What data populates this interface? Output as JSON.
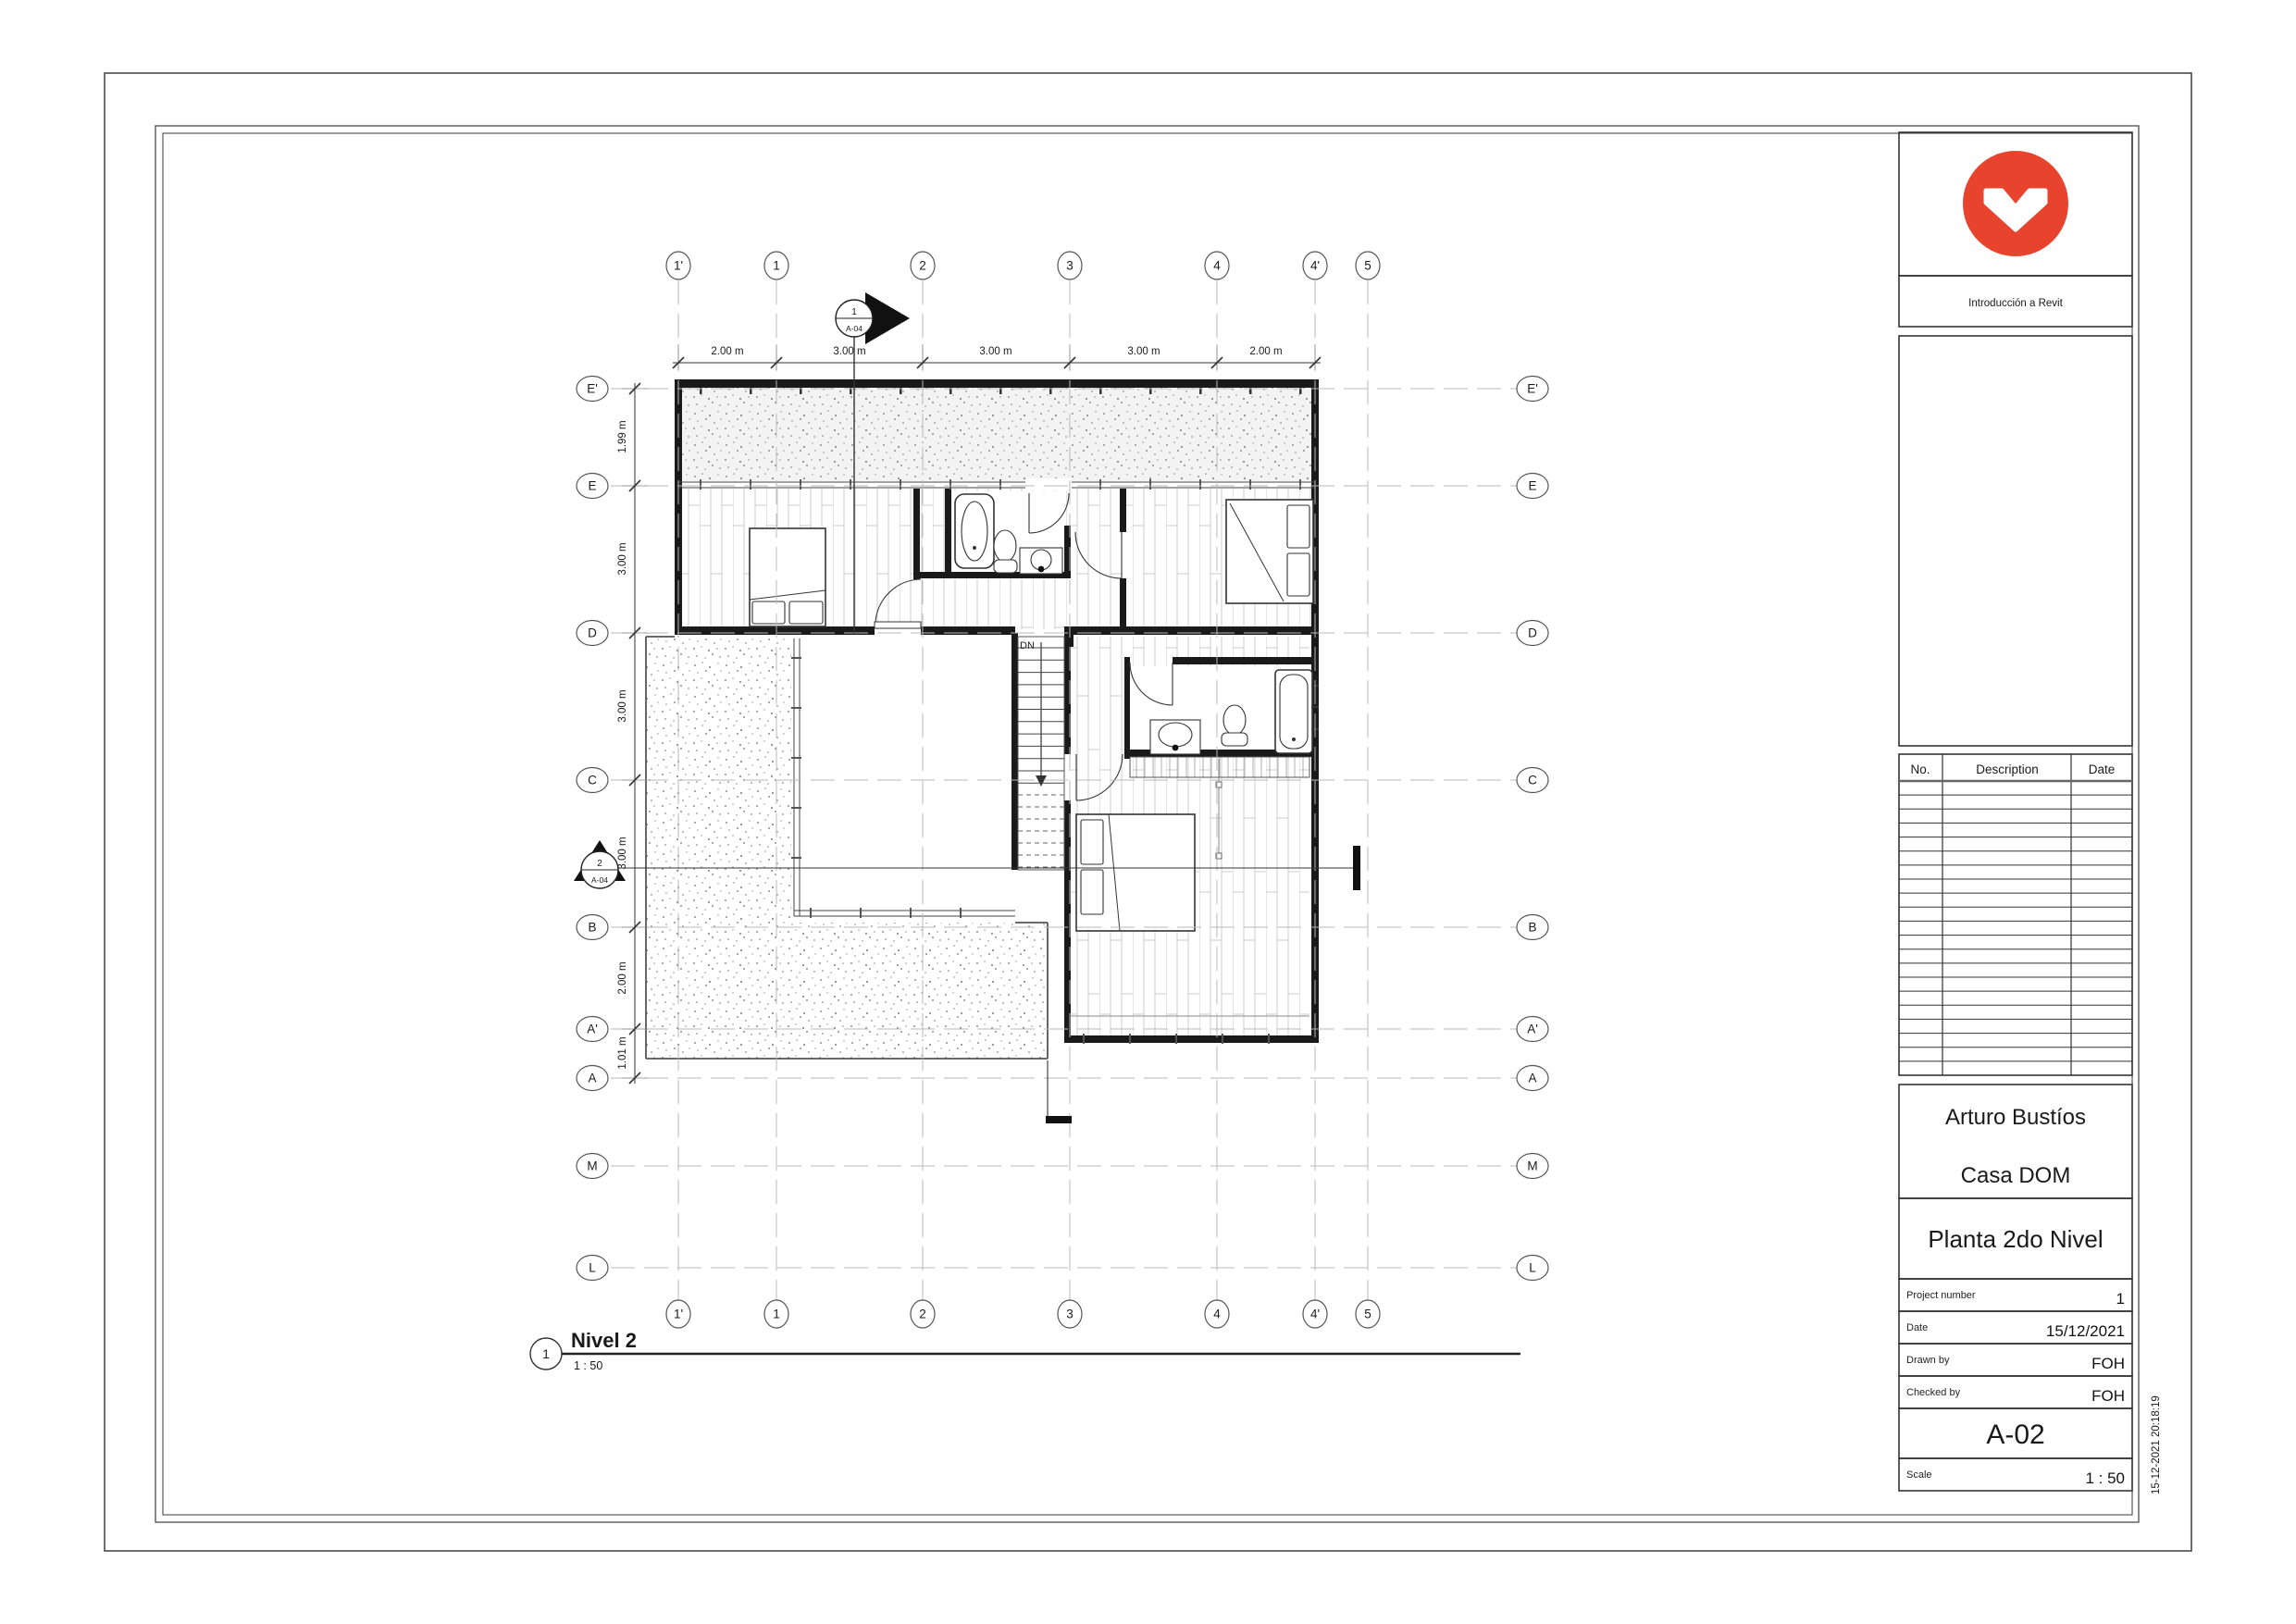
{
  "plan": {
    "view_title": {
      "number": "1",
      "name": "Nivel 2",
      "scale": "1 : 50"
    },
    "grids": {
      "vertical": [
        "1'",
        "1",
        "2",
        "3",
        "4",
        "4'",
        "5"
      ],
      "horizontal": [
        "E'",
        "E",
        "D",
        "C",
        "B",
        "A'",
        "A",
        "M",
        "L"
      ]
    },
    "dims_top": [
      "2.00 m",
      "3.00 m",
      "3.00 m",
      "3.00 m",
      "2.00 m"
    ],
    "dims_left": [
      "1.99 m",
      "3.00 m",
      "3.00 m",
      "3.00 m",
      "2.00 m",
      "1.01 m"
    ],
    "sections": [
      {
        "number": "1",
        "sheet": "A-04"
      },
      {
        "number": "2",
        "sheet": "A-04"
      }
    ],
    "stair_label": "DN"
  },
  "titleblock": {
    "course": "Introducción a Revit",
    "logo_color": "#E8432D",
    "revisions": {
      "col_no": "No.",
      "col_desc": "Description",
      "col_date": "Date",
      "rows": 21
    },
    "owner": "Arturo Bustíos",
    "project": "Casa DOM",
    "sheet_name": "Planta 2do Nivel",
    "project_number_label": "Project number",
    "project_number": "1",
    "date_label": "Date",
    "date": "15/12/2021",
    "drawn_label": "Drawn by",
    "drawn": "FOH",
    "checked_label": "Checked by",
    "checked": "FOH",
    "sheet_number": "A-02",
    "scale_label": "Scale",
    "scale": "1 : 50"
  },
  "timestamp": "15-12-2021 20:18:19"
}
